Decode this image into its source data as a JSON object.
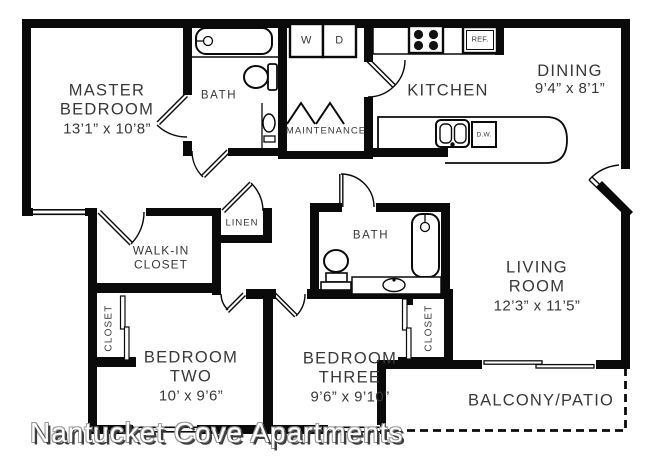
{
  "watermark": "Nantucket Cove Apartments",
  "rooms": {
    "master_bedroom": {
      "line1": "MASTER",
      "line2": "BEDROOM",
      "dims": "13’1” x 10’8”"
    },
    "bath_upper": {
      "label": "BATH"
    },
    "maintenance": {
      "label": "MAINTENANCE"
    },
    "kitchen": {
      "label": "KITCHEN"
    },
    "dining": {
      "line1": "DINING",
      "dims": "9’4” x 8’1”"
    },
    "walk_in_closet": {
      "line1": "WALK-IN",
      "line2": "CLOSET"
    },
    "linen": {
      "label": "LINEN"
    },
    "closet_left": {
      "label": "CLOSET"
    },
    "bath_lower": {
      "label": "BATH"
    },
    "closet_right": {
      "label": "CLOSET"
    },
    "bedroom_two": {
      "line1": "BEDROOM",
      "line2": "TWO",
      "dims": "10’ x 9’6”"
    },
    "bedroom_three": {
      "line1": "BEDROOM",
      "line2": "THREE",
      "dims": "9’6” x 9’10”"
    },
    "living_room": {
      "line1": "LIVING",
      "line2": "ROOM",
      "dims": "12’3” x 11’5”"
    },
    "balcony": {
      "label": "BALCONY/PATIO"
    }
  },
  "appliances": {
    "washer": "W",
    "dryer": "D",
    "refrigerator": "REF.",
    "dishwasher": "D.W."
  },
  "colors": {
    "wall": "#0a0a0a",
    "text": "#383838",
    "background": "#ffffff"
  }
}
